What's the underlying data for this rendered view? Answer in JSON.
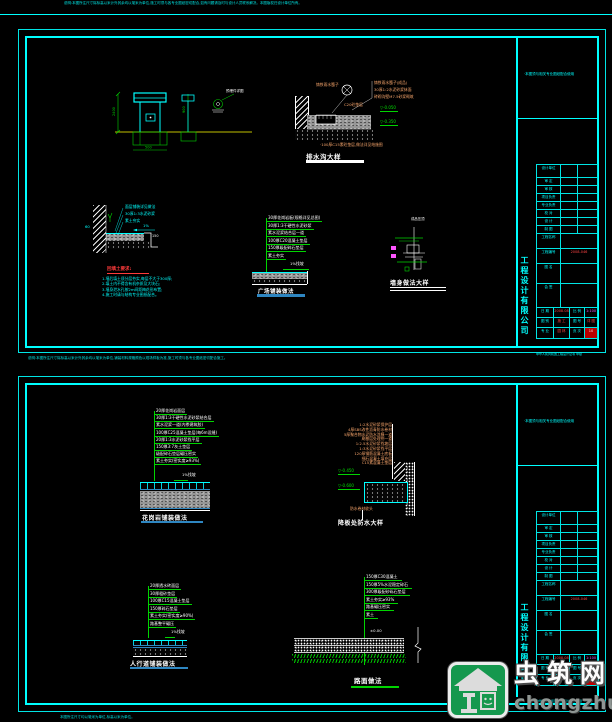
{
  "page": {
    "top_note": "说明:本图所注尺寸除标高以米计外其余均以毫米为单位,施工时须与各专业图纸密切配合,如有问题请及时与设计人员联系解决。本图版权归设计单位所有。",
    "mid_note": "说明:本图所注尺寸除标高以米计外其余均以毫米为单位,铺装材料规格颜色以现场样板为准,施工时须与各专业图纸密切配合施工。",
    "bottom_note": "本图所注尺寸均以毫米为单位,标高以米为单位。"
  },
  "titleblock": {
    "note": "·本图须与相关专业图纸配合使用",
    "company": "工程设计有限公司",
    "rows": [
      "设计单位",
      "审 定",
      "审 核",
      "项目负责",
      "专业负责",
      "校 对",
      "设 计",
      "制 图"
    ],
    "tall": [
      {
        "label": "工程名称",
        "value": ""
      },
      {
        "label": "工程编号",
        "value": "2008-046"
      },
      {
        "label": "图 名",
        "value": ""
      },
      {
        "label": "会 签",
        "value": ""
      }
    ],
    "grid": {
      "r1": [
        "日 期",
        "2008.08",
        "比 例",
        "1:100"
      ],
      "r2": [
        "图 别",
        "施 工",
        "图 号",
        "详 图"
      ],
      "r3": [
        "专 业",
        "园 林",
        "页 次",
        "10"
      ]
    },
    "cert": "中华人民共和国工程设计证书 甲级"
  },
  "sheet1": {
    "d1": {
      "dims": [
        "2400",
        "900",
        "500"
      ],
      "note": "预埋件详图"
    },
    "d2": {
      "title": "排水沟大样",
      "grate_label": "铸铁雨水篦子",
      "notes": [
        "铸铁雨水篦子(成品)",
        "30厚1:2水泥砂浆抹面",
        "砖砌沟壁M7.5砂浆砌筑"
      ],
      "mid_note": "C20砼垫层",
      "elevations": [
        "-0.050",
        "-0.350"
      ],
      "bottom_note": "·100厚C15素砼垫层,做法详见结施图"
    },
    "d3": {
      "title": "回填土要求:",
      "labels": [
        "面层铺装详见做法",
        "30厚1:3水泥砂浆",
        "素土夯实"
      ],
      "slope": "1%",
      "dim": "60",
      "step": "150",
      "notes": [
        "1.墙后填土须分层夯实,每层不大于300厚;",
        "2.填土内不得含有机杂质及大块石;",
        "3.墙身泄水孔按2m间距梅花形布置;",
        "4.施工时请与结构专业图纸配合。"
      ]
    },
    "d4": {
      "title": "广场铺装做法",
      "layers": [
        "30厚花岗岩板(规格详见总图)",
        "30厚1:3干硬性水泥砂浆",
        "素水泥浆结合层一道",
        "100厚C20混凝土垫层",
        "150厚级配碎石垫层",
        "素土夯实"
      ],
      "slope_label": "1%找坡"
    },
    "d5": {
      "title": "墙身做法大样",
      "label": "成品压顶"
    }
  },
  "sheet2": {
    "d6": {
      "title": "花岗岩铺装做法",
      "layers": [
        "20厚花岗岩面层",
        "30厚1:3干硬性水泥砂浆结合层",
        "素水泥浆一道(内掺建筑胶)",
        "100厚C25混凝土垫层(每6m设缝)",
        "20厚1:3水泥砂浆找平层",
        "150厚3:7灰土垫层",
        "级配碎石垫层碾压密实",
        "素土夯实(密实度≥93%)"
      ],
      "slope_label": "1%找坡"
    },
    "d7": {
      "title": "降板处防水大样",
      "notes": [
        "1:2水泥砂浆保护层",
        "4厚SBS改性沥青防水卷材",
        "5厚聚合物水泥防水涂膜一道",
        "刷基层处理剂一道",
        "1:2.5水泥砂浆找坡层",
        "1:3水泥砂浆找平层",
        "120厚钢筋混凝土底板",
        "细石混凝土填充层",
        "C15素混凝土垫层"
      ],
      "elevations": [
        "-0.450",
        "-0.600"
      ],
      "bottom_label": "防水卷材收头"
    },
    "d8": {
      "title": "人行道铺装做法",
      "layers": [
        "20厚透水砖面层",
        "30厚粗砂垫层",
        "100厚C15混凝土垫层",
        "150厚碎石垫层",
        "素土夯实(密实度≥90%)",
        "路基整平碾压"
      ],
      "slope_label": "1%找坡"
    },
    "d9": {
      "title": "路面做法",
      "layers": [
        "150厚C30混凝土",
        "150厚5%水泥稳定碎石",
        "300厚级配砂砾石垫层",
        "素土夯实≥93%",
        "路基碾压密实",
        "素土"
      ],
      "level": "±0.00"
    }
  },
  "watermark": {
    "brand": "虫筑网",
    "domain": "chongzhu.cn"
  }
}
